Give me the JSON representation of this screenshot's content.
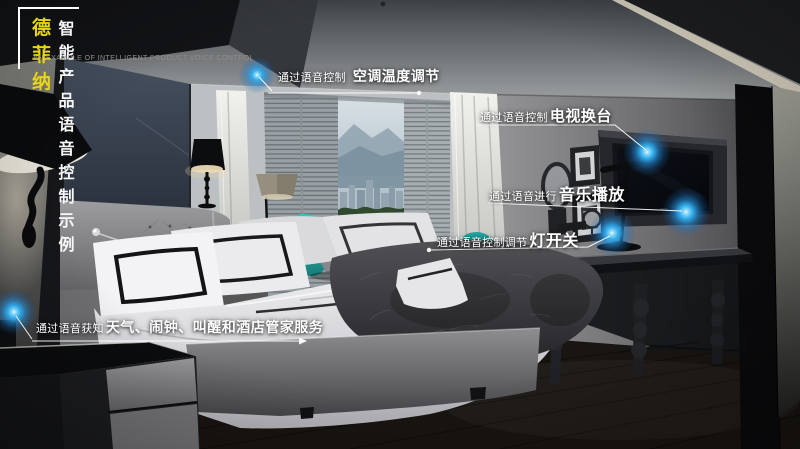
{
  "header": {
    "brand": "德菲纳",
    "title": "智能产品语音控制示例",
    "subtitle": "AN EXAMPLE OF INTELLIGENT PRODUCT VOICE CONTROL"
  },
  "callouts": [
    {
      "prefix": "通过语音控制",
      "label": "空调温度调节"
    },
    {
      "prefix": "通过语音控制",
      "label": "电视换台"
    },
    {
      "prefix": "通过语音进行",
      "label": "音乐播放"
    },
    {
      "prefix": "通过语音控制调节",
      "label": "灯开关"
    },
    {
      "prefix": "通过语音获知",
      "label": "天气、闹钟、叫醒和酒店管家服务"
    }
  ],
  "colors": {
    "brand_yellow": "#e8d41a",
    "hotspot_blue": "#31aae9",
    "callout_text": "#ffffff"
  }
}
